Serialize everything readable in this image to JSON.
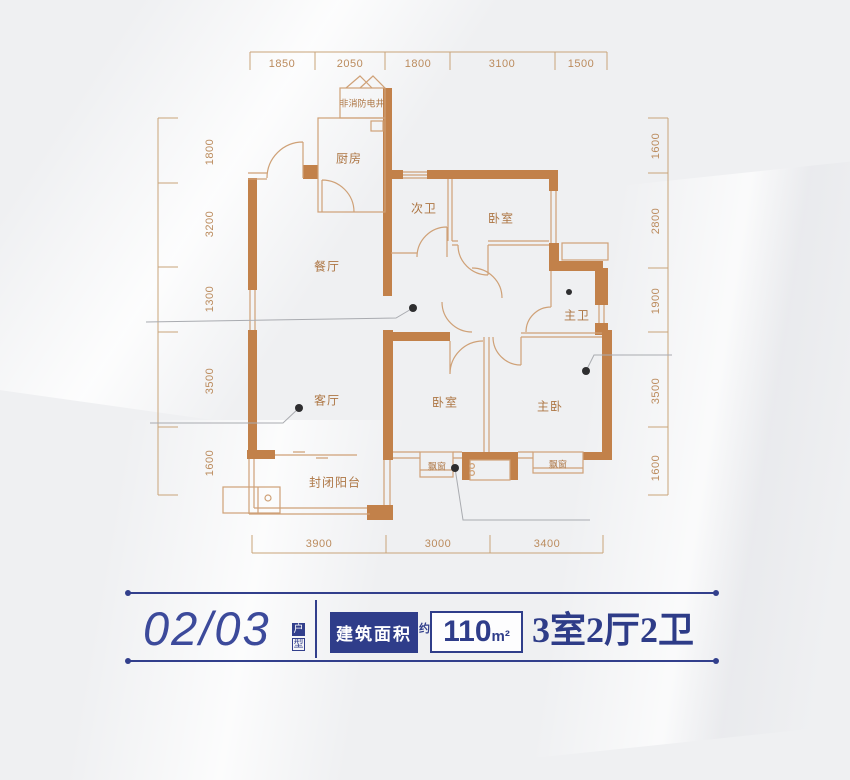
{
  "colors": {
    "background": "#eff0f2",
    "wall": "#c2814a",
    "thin_line": "#cfa177",
    "ruler": "#c9a479",
    "room_label": "#ad7644",
    "navy": "#2f3d8a",
    "leader": "#a9abb0",
    "dot": "#2e2e30"
  },
  "floorplan": {
    "dimensions": {
      "top": [
        "1850",
        "2050",
        "1800",
        "3100",
        "1500"
      ],
      "left": [
        "1800",
        "3200",
        "1300",
        "3500",
        "1600"
      ],
      "right": [
        "1600",
        "2800",
        "1900",
        "3500",
        "1600"
      ],
      "bottom": [
        "3900",
        "3000",
        "3400"
      ]
    },
    "dim_labels": [
      {
        "t": "1850",
        "x": 282,
        "y": 64,
        "rot": false
      },
      {
        "t": "2050",
        "x": 350,
        "y": 64,
        "rot": false
      },
      {
        "t": "1800",
        "x": 418,
        "y": 64,
        "rot": false
      },
      {
        "t": "3100",
        "x": 502,
        "y": 64,
        "rot": false
      },
      {
        "t": "1500",
        "x": 581,
        "y": 64,
        "rot": false
      },
      {
        "t": "1800",
        "x": 210,
        "y": 152,
        "rot": true
      },
      {
        "t": "3200",
        "x": 210,
        "y": 224,
        "rot": true
      },
      {
        "t": "1300",
        "x": 210,
        "y": 299,
        "rot": true
      },
      {
        "t": "3500",
        "x": 210,
        "y": 381,
        "rot": true
      },
      {
        "t": "1600",
        "x": 210,
        "y": 463,
        "rot": true
      },
      {
        "t": "1600",
        "x": 656,
        "y": 146,
        "rot": true
      },
      {
        "t": "2800",
        "x": 656,
        "y": 221,
        "rot": true
      },
      {
        "t": "1900",
        "x": 656,
        "y": 301,
        "rot": true
      },
      {
        "t": "3500",
        "x": 656,
        "y": 391,
        "rot": true
      },
      {
        "t": "1600",
        "x": 656,
        "y": 468,
        "rot": true
      },
      {
        "t": "3900",
        "x": 319,
        "y": 544,
        "rot": false
      },
      {
        "t": "3000",
        "x": 438,
        "y": 544,
        "rot": false
      },
      {
        "t": "3400",
        "x": 547,
        "y": 544,
        "rot": false
      }
    ],
    "room_labels": [
      {
        "t": "厨房",
        "x": 349,
        "y": 158,
        "small": false
      },
      {
        "t": "次卫",
        "x": 424,
        "y": 208,
        "small": false
      },
      {
        "t": "卧室",
        "x": 501,
        "y": 218,
        "small": false
      },
      {
        "t": "餐厅",
        "x": 327,
        "y": 266,
        "small": false
      },
      {
        "t": "主卫",
        "x": 577,
        "y": 315,
        "small": false
      },
      {
        "t": "客厅",
        "x": 327,
        "y": 400,
        "small": false
      },
      {
        "t": "卧室",
        "x": 445,
        "y": 402,
        "small": false
      },
      {
        "t": "主卧",
        "x": 550,
        "y": 406,
        "small": false
      },
      {
        "t": "封闭阳台",
        "x": 335,
        "y": 482,
        "small": false
      },
      {
        "t": "飘窗",
        "x": 437,
        "y": 466,
        "small": true
      },
      {
        "t": "飘窗",
        "x": 558,
        "y": 464,
        "small": true
      },
      {
        "t": "非消防电井",
        "x": 362,
        "y": 103,
        "small": true
      }
    ]
  },
  "title": {
    "unit_number": "02/03",
    "unit_suffix_char1": "户",
    "unit_suffix_char2": "型",
    "area_label": "建筑面积",
    "area_approx": "约",
    "area_value": "110",
    "area_unit": "m²",
    "layout_summary": "3室2厅2卫"
  }
}
